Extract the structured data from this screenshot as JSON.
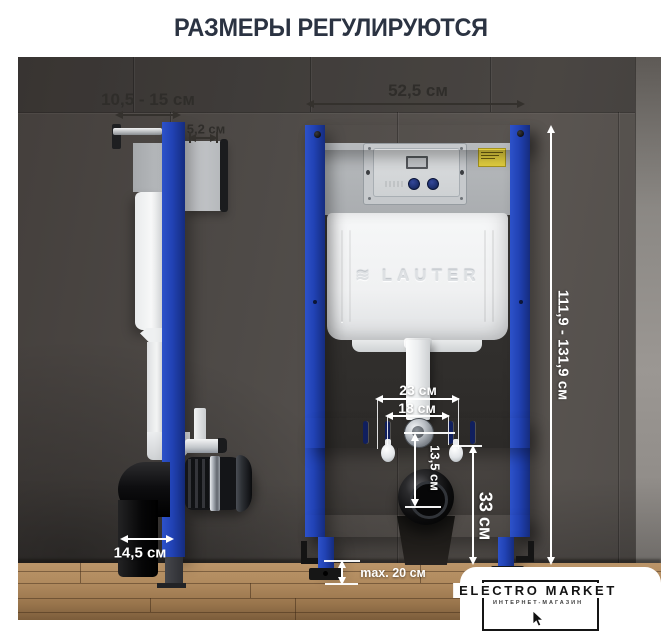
{
  "header": {
    "title": "РАЗМЕРЫ РЕГУЛИРУЮТСЯ"
  },
  "dimensions": {
    "wall_offset": "10,5 - 15 см",
    "plate_depth": "5,2 см",
    "frame_width": "52,5 см",
    "frame_height": "111,9 - 131,9 см",
    "stud_spacing_outer": "23 см",
    "stud_spacing_inner": "18 см",
    "outlet_drop": "13,5 см",
    "outlet_height": "33 см",
    "frame_depth": "14,5 см",
    "foot_adjust": "max. 20 см"
  },
  "cistern": {
    "embossed_brand": "LAUTER",
    "embossed_icon": "wave-icon"
  },
  "logo": {
    "title": "ELECTRO MARKET",
    "tagline": "ИНТЕРНЕТ-МАГАЗИН"
  },
  "colors": {
    "frame_blue": "#1e3fae",
    "title_navy": "#2b3342",
    "wall_gray": "#514d4a",
    "floor_wood": "#a8845a",
    "sticker_yellow": "#e3cf3f",
    "dimension_white": "#ffffff",
    "dimension_dark": "#34312d"
  }
}
